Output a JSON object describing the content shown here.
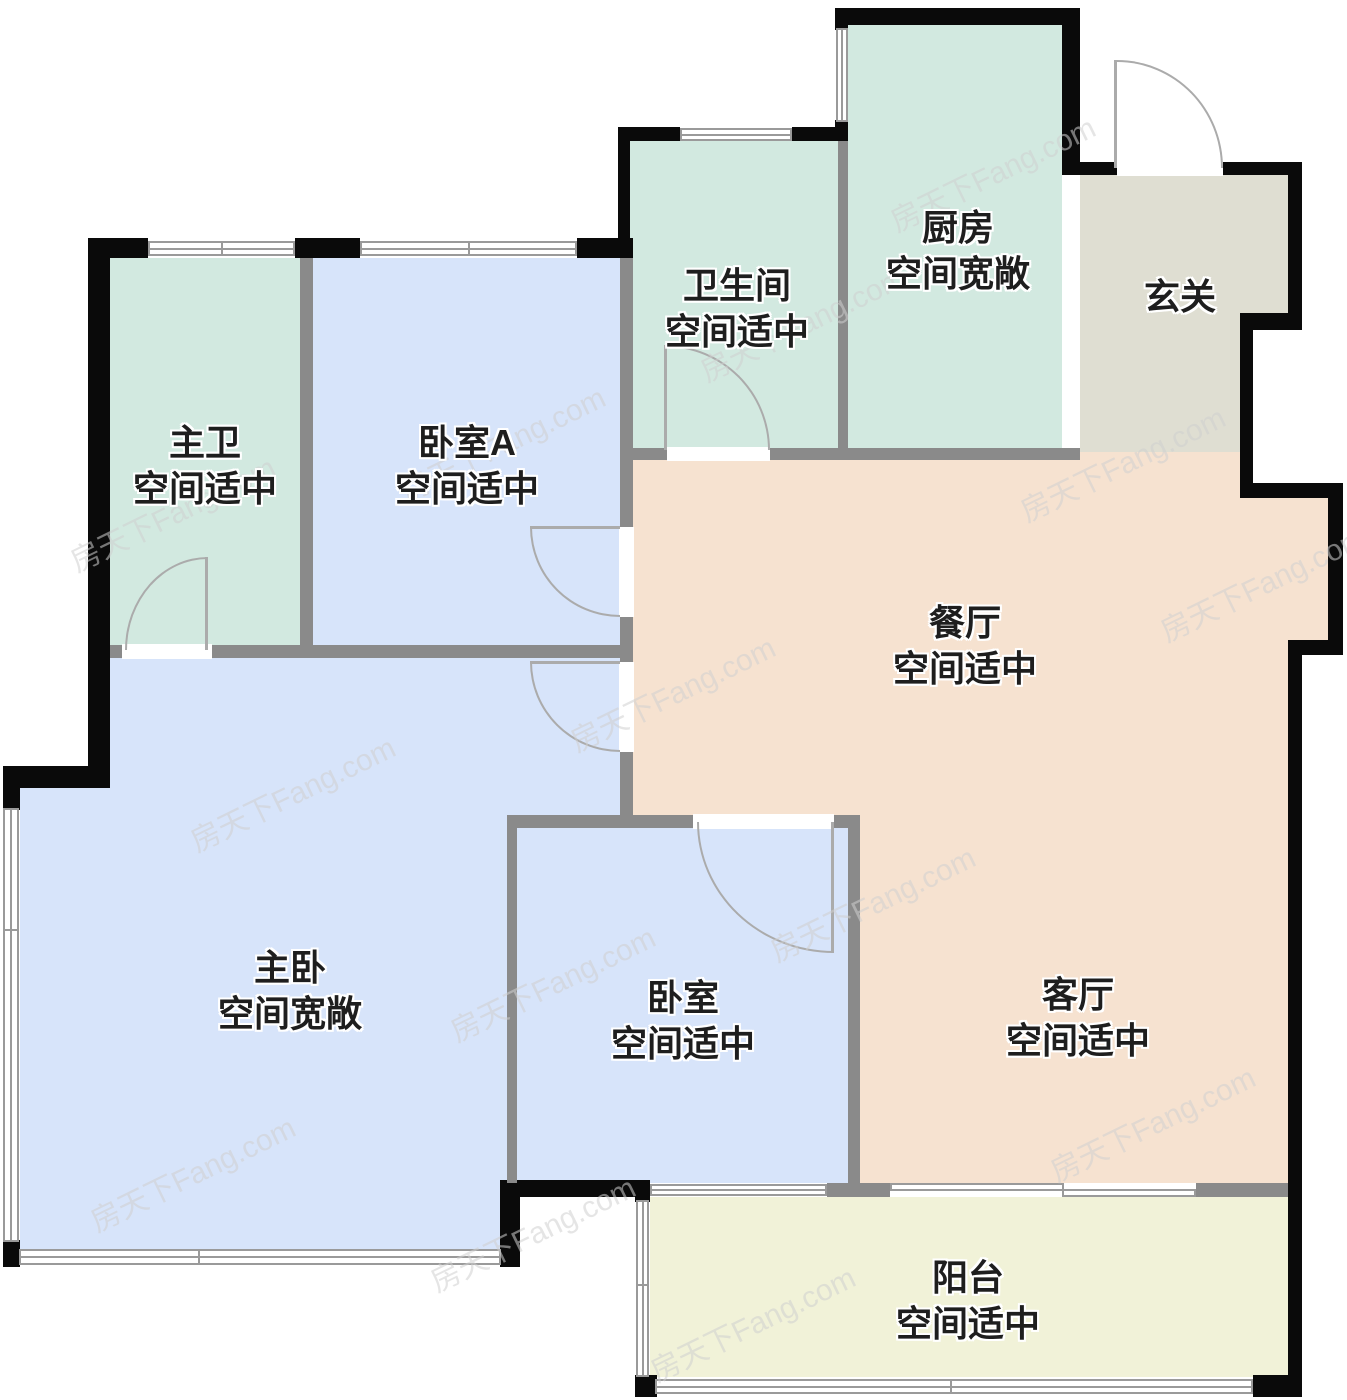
{
  "watermark": {
    "text": "房天下Fang.com"
  },
  "rooms": [
    {
      "id": "master-bath",
      "name": "主卫",
      "status": "空间适中",
      "color": "#d2e9e0"
    },
    {
      "id": "bedroom-a",
      "name": "卧室A",
      "status": "空间适中",
      "color": "#d7e4fa"
    },
    {
      "id": "bathroom",
      "name": "卫生间",
      "status": "空间适中",
      "color": "#d2e9e0"
    },
    {
      "id": "kitchen",
      "name": "厨房",
      "status": "空间宽敞",
      "color": "#d2e9e0"
    },
    {
      "id": "foyer",
      "name": "玄关",
      "status": "",
      "color": "#dfded2"
    },
    {
      "id": "dining",
      "name": "餐厅",
      "status": "空间适中",
      "color": "#f6e2d0"
    },
    {
      "id": "master-bedroom",
      "name": "主卧",
      "status": "空间宽敞",
      "color": "#d7e4fa"
    },
    {
      "id": "bedroom",
      "name": "卧室",
      "status": "空间适中",
      "color": "#d7e4fa"
    },
    {
      "id": "living",
      "name": "客厅",
      "status": "空间适中",
      "color": "#f6e2d0"
    },
    {
      "id": "balcony",
      "name": "阳台",
      "status": "空间适中",
      "color": "#f1f2d8"
    }
  ],
  "palette": {
    "outer_wall": "#0a0a0a",
    "inner_wall": "#8a8a8a",
    "window_line": "#9a9a9a",
    "door_arc": "#ababab",
    "label_text": "#1e1e1e",
    "watermark": "#d0d0d0",
    "background": "#ffffff"
  }
}
